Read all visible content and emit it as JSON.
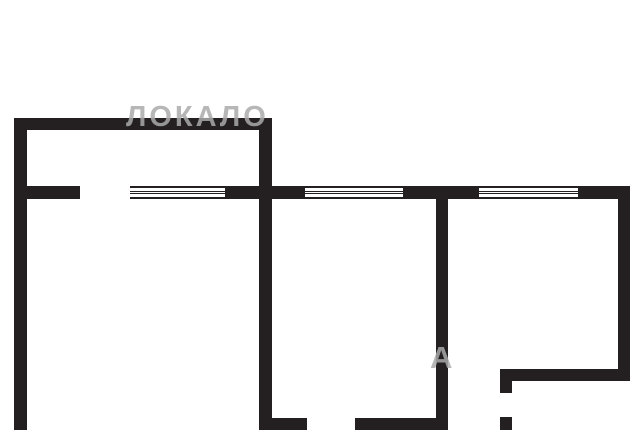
{
  "watermark": {
    "row1_text": "ЛОКАЛО",
    "row2_fragment": "А",
    "color": "#aaaaaa"
  },
  "floorplan": {
    "background_color": "#ffffff",
    "wall_color": "#242021",
    "canvas": {
      "width": 640,
      "height": 430
    },
    "walls": [
      {
        "name": "top-wall",
        "x": 14,
        "y": 118,
        "w": 258,
        "h": 12
      },
      {
        "name": "left-wall",
        "x": 14,
        "y": 118,
        "w": 13,
        "h": 312
      },
      {
        "name": "center-left-wall",
        "x": 259,
        "y": 130,
        "w": 13,
        "h": 300
      },
      {
        "name": "center-left-wall-foot",
        "x": 259,
        "y": 418,
        "w": 48,
        "h": 12
      },
      {
        "name": "mid-wall-left-stub",
        "x": 14,
        "y": 186,
        "w": 66,
        "h": 13
      },
      {
        "name": "mid-wall-segment-b",
        "x": 225,
        "y": 186,
        "w": 80,
        "h": 13
      },
      {
        "name": "mid-wall-segment-c",
        "x": 403,
        "y": 186,
        "w": 76,
        "h": 13
      },
      {
        "name": "mid-wall-segment-d",
        "x": 578,
        "y": 186,
        "w": 52,
        "h": 13
      },
      {
        "name": "center-right-wall",
        "x": 436,
        "y": 199,
        "w": 12,
        "h": 231
      },
      {
        "name": "bottom-wall-segment",
        "x": 355,
        "y": 418,
        "w": 93,
        "h": 12
      },
      {
        "name": "right-outer-wall",
        "x": 618,
        "y": 186,
        "w": 12,
        "h": 195
      },
      {
        "name": "lower-right-wall",
        "x": 500,
        "y": 369,
        "w": 130,
        "h": 12
      },
      {
        "name": "lower-right-stub-top",
        "x": 500,
        "y": 369,
        "w": 12,
        "h": 24
      },
      {
        "name": "lower-right-stub-bottom",
        "x": 500,
        "y": 417,
        "w": 12,
        "h": 13
      }
    ],
    "windows": [
      {
        "name": "window-left",
        "x": 130,
        "y": 186,
        "w": 95
      },
      {
        "name": "window-middle",
        "x": 305,
        "y": 186,
        "w": 98
      },
      {
        "name": "window-right",
        "x": 479,
        "y": 186,
        "w": 99
      }
    ],
    "door_openings": [
      {
        "name": "door-opening-left-room",
        "x": 80,
        "y": 186,
        "w": 50,
        "h": 13
      },
      {
        "name": "door-opening-bottom-left",
        "x": 307,
        "y": 418,
        "w": 48,
        "h": 12
      },
      {
        "name": "door-opening-bottom-right",
        "x": 448,
        "y": 418,
        "w": 52,
        "h": 12
      },
      {
        "name": "door-opening-lower-right",
        "x": 500,
        "y": 393,
        "w": 12,
        "h": 24
      }
    ]
  }
}
